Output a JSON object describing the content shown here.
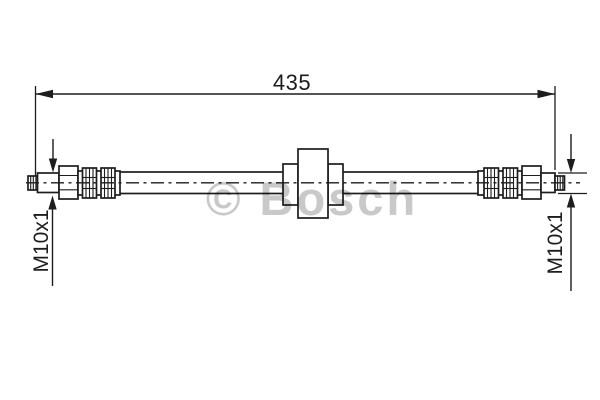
{
  "drawing": {
    "watermark_text": "© Bosch",
    "overall_length_label": "435",
    "left_thread_label": "M10x1",
    "right_thread_label": "M10x1"
  },
  "colors": {
    "line": "#1d1d1d",
    "watermark": "#c9c9c9",
    "background": "#ffffff"
  }
}
